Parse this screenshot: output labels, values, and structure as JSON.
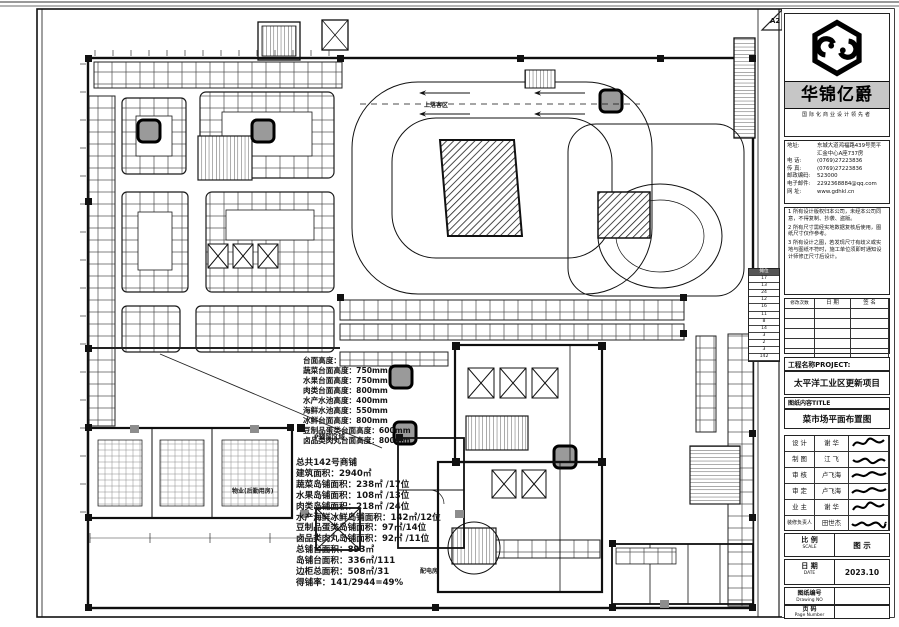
{
  "title_block": {
    "sheet_size": "A2",
    "brand": {
      "name": "华锦亿爵",
      "tagline": "国际化商业设计领先者"
    },
    "contact": {
      "address_label": "地址:",
      "address": "东城大道鸿福路439号莞平 汇金中心A座737房",
      "phone_label": "电 话:",
      "phone": "(0769)27223836",
      "fax_label": "传 真:",
      "fax": "(0769)27223836",
      "postcode_label": "邮政编码:",
      "postcode": "523000",
      "email_label": "电子邮件:",
      "email": "2292368884@qq.com",
      "web_label": "网 址:",
      "web": "www.gdhkl.cn"
    },
    "notes": [
      "1 所有设计版权归本公司，未经本公司同意，不得复制、抄袭、盗版。",
      "2 所有尺寸需经实地数据复核后使用，图纸尺寸仅作参考。",
      "3 所有设计之图，若发现尺寸有歧义或实地与图纸不符时，施工单位须即时通知设计师修正尺寸后设计。"
    ],
    "revision_table": {
      "headers": [
        "修改次数",
        "日 期",
        "签 名"
      ]
    },
    "project_label": "工程名称PROJECT:",
    "project_name": "太平洋工业区更新项目",
    "content_label": "图纸内容TITLE",
    "drawing_title": "菜市场平面布置图",
    "signatures": [
      {
        "role": "设 计",
        "name": "谢 华"
      },
      {
        "role": "制 图",
        "name": "江 飞"
      },
      {
        "role": "审 核",
        "name": "卢飞海"
      },
      {
        "role": "审 定",
        "name": "卢飞海"
      },
      {
        "role": "业 主",
        "name": "谢 华"
      },
      {
        "role": "装修负责人",
        "name": "田世杰"
      }
    ],
    "scale": {
      "label": "比 例",
      "label_en": "SCALE",
      "value": "图 示"
    },
    "date": {
      "label": "日 期",
      "label_en": "DATE",
      "value": "2023.10"
    },
    "drawing_no": {
      "label": "图纸编号",
      "label_en": "Drawing NO",
      "value": ""
    },
    "page_no": {
      "label": "页 码",
      "label_en": "Page Number",
      "value": ""
    }
  },
  "annotations": {
    "heights": {
      "lines": [
        "台面高度：",
        "蔬菜台面高度：750mm",
        "水果台面高度：750mm",
        "肉类台面高度：800mm",
        "水产水池高度：400mm",
        "海鲜水池高度：550mm",
        "冰鲜台面高度：800mm",
        "豆制品蛋类台面高度：600mm",
        "卤品类肉丸台面高度：800mm"
      ]
    },
    "stats": {
      "lines": [
        "总共142号商铺",
        "建筑面积：2940㎡",
        "蔬菜岛铺面积：238㎡ /17位",
        "水果岛铺面积：108㎡ /13位",
        "肉类岛铺面积：218㎡ /24位",
        "水产海鲜冰鲜岛铺面积：142㎡/12位",
        "豆制品蛋类岛铺面积：97㎡/14位",
        "卤品类肉丸岛铺面积：92㎡ /11位",
        "总铺台面积：893㎡",
        "岛铺台面积：336㎡/111",
        "边柜总面积：508㎡/31",
        "得铺率：141/2944=49%"
      ]
    }
  },
  "stall_count_table": {
    "header": "摊位",
    "rows": [
      "17",
      "13",
      "24",
      "12",
      "16",
      "11",
      "8",
      "14",
      "3",
      "2",
      "3",
      "142"
    ]
  },
  "plan_labels": {
    "plaza": "P预留区域",
    "logistics": "物业(后勤用房)",
    "dropoff": "上落客区",
    "power_room": "配电房"
  }
}
